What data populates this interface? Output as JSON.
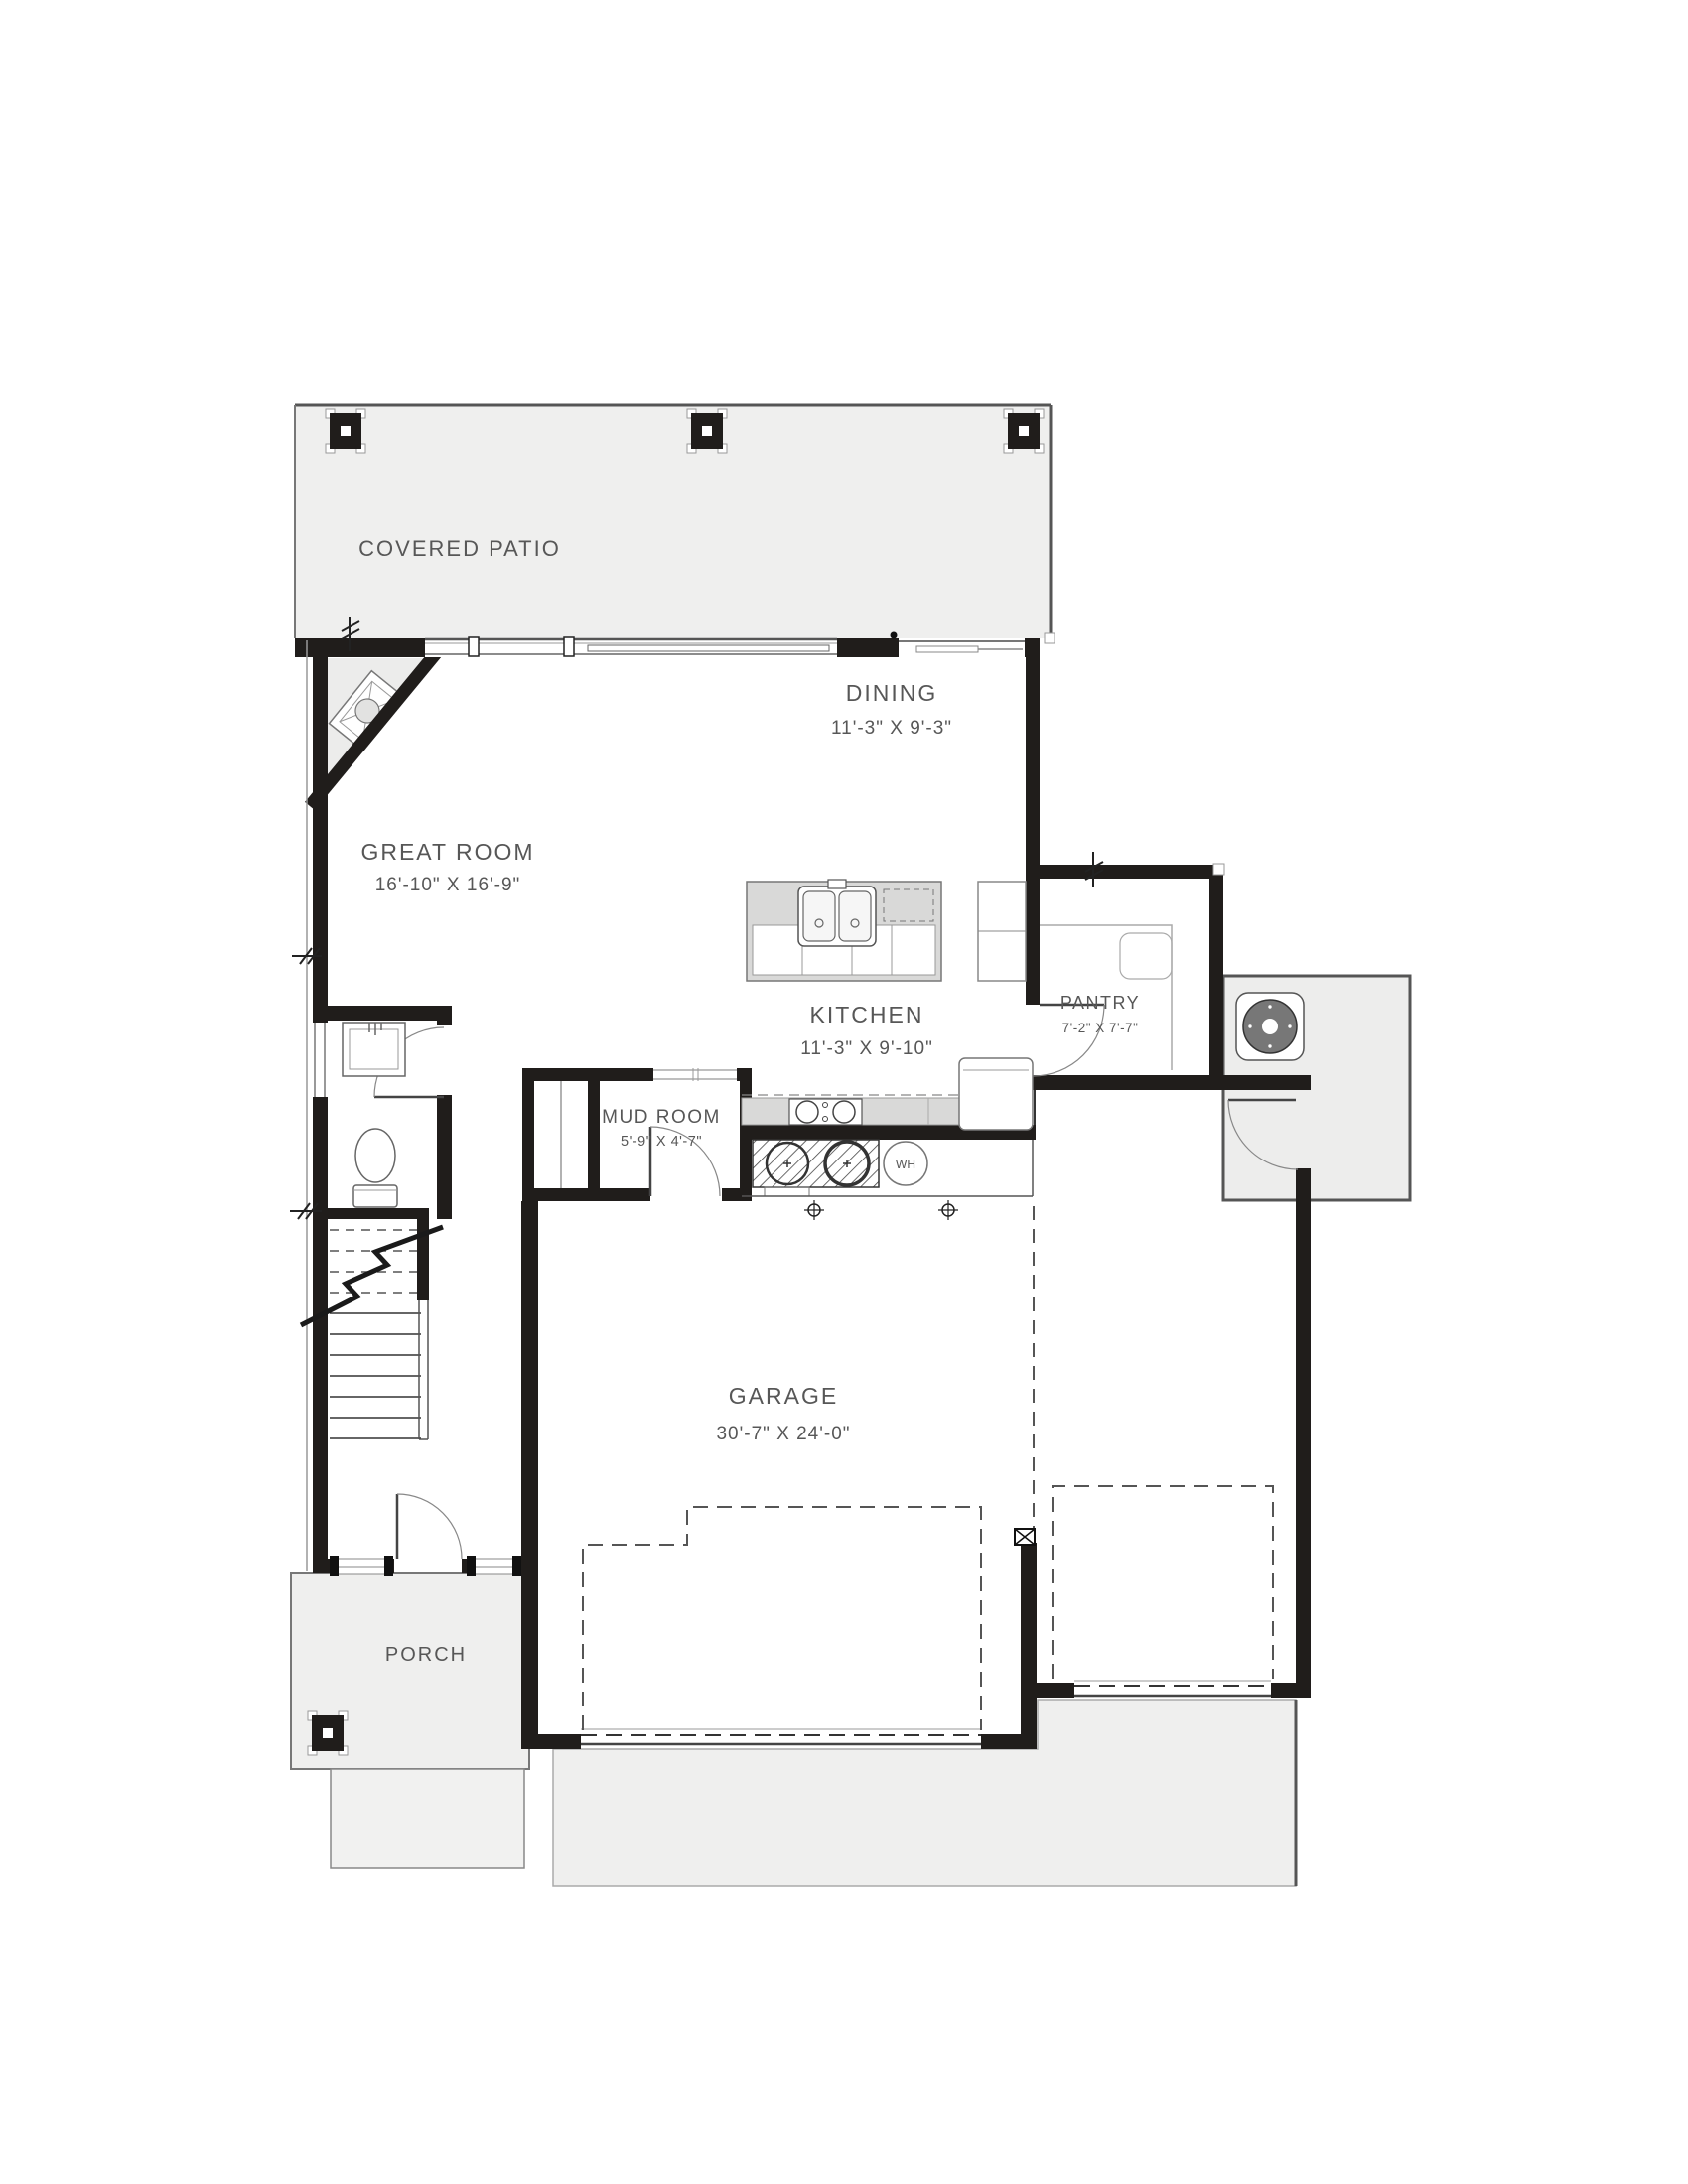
{
  "rooms": {
    "covered_patio": {
      "label": "COVERED PATIO"
    },
    "dining": {
      "label": "DINING",
      "dims": "11'-3\" X 9'-3\""
    },
    "great_room": {
      "label": "GREAT ROOM",
      "dims": "16'-10\" X 16'-9\""
    },
    "kitchen": {
      "label": "KITCHEN",
      "dims": "11'-3\" X 9'-10\""
    },
    "pantry": {
      "label": "PANTRY",
      "dims": "7'-2\" X 7'-7\""
    },
    "mud_room": {
      "label": "MUD ROOM",
      "dims": "5'-9\" X 4'-7\""
    },
    "garage": {
      "label": "GARAGE",
      "dims": "30'-7\" X 24'-0\""
    },
    "porch": {
      "label": "PORCH"
    }
  },
  "fixtures": {
    "water_heater": "WH"
  },
  "colors": {
    "wall": "#201d1b",
    "slab": "#efefee",
    "counter": "#d9d9d8",
    "label_text": "#575757"
  }
}
